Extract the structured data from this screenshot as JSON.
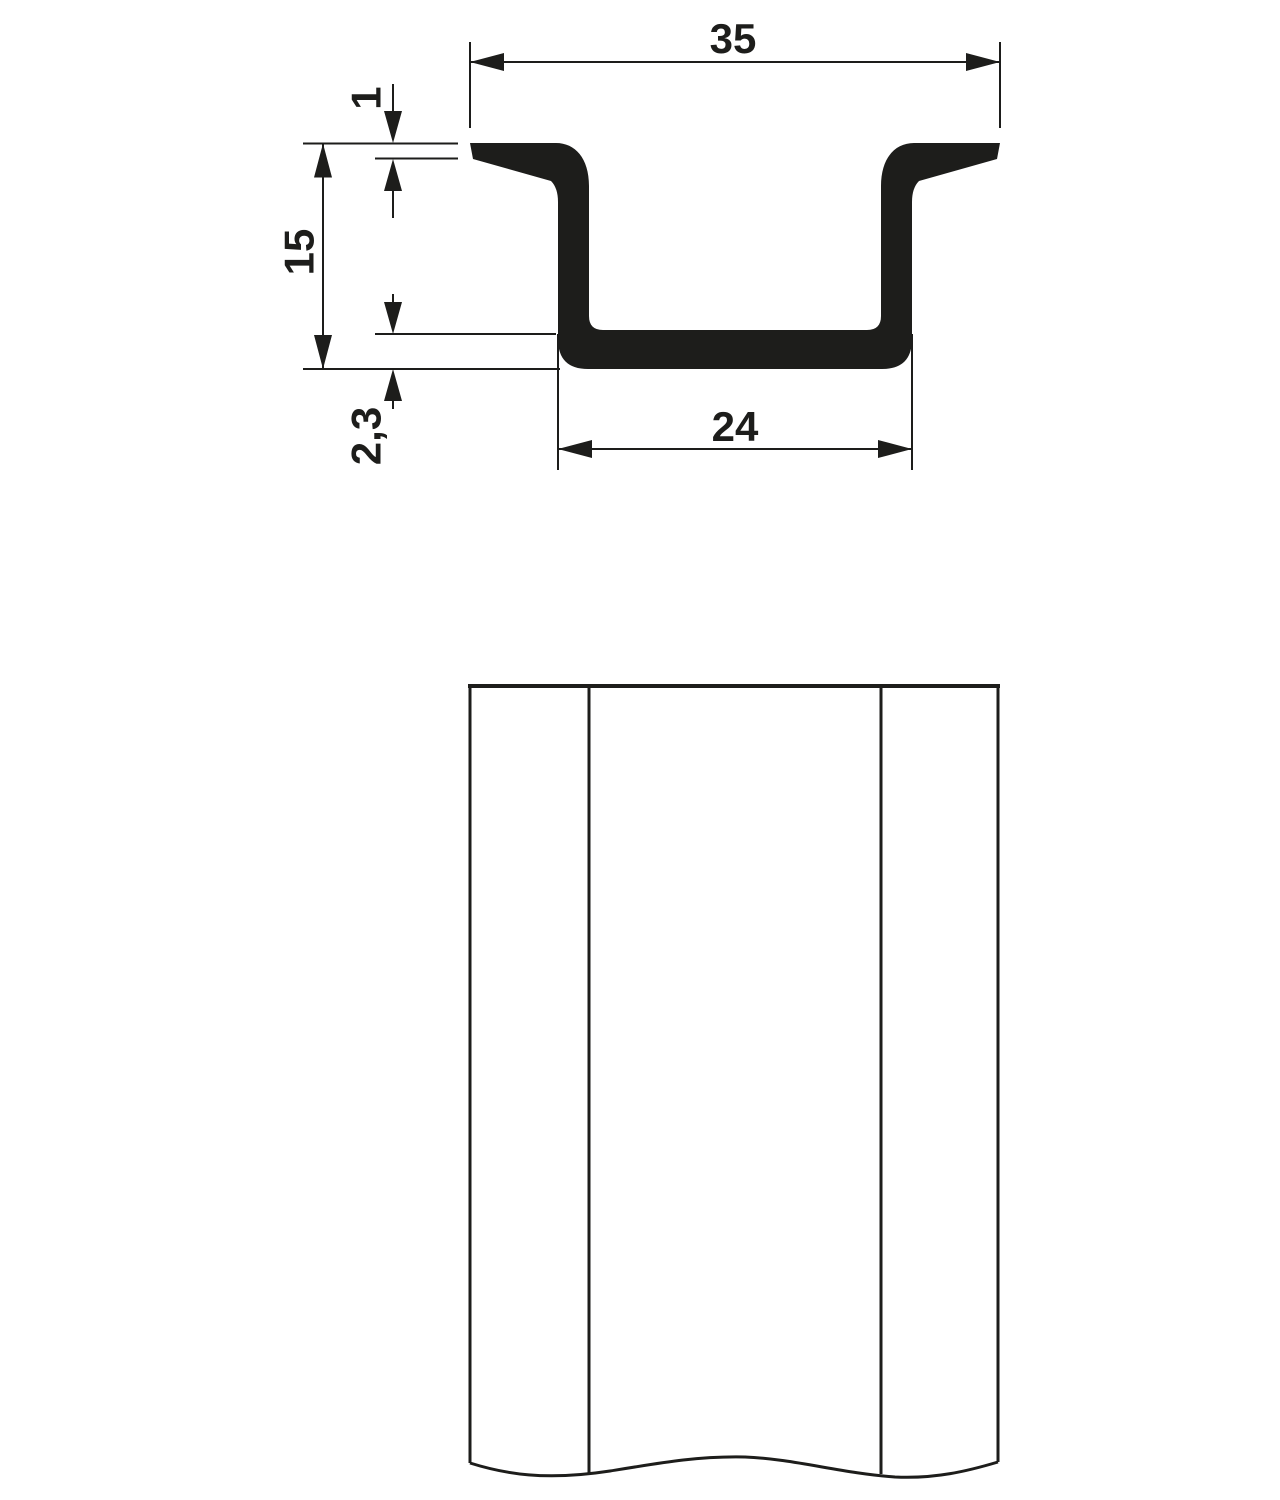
{
  "drawing": {
    "background": "#ffffff",
    "stroke_color": "#1d1d1b",
    "dims": {
      "overall_width": "35",
      "flange_thickness": "1",
      "overall_height": "15",
      "base_thickness": "2,3",
      "inner_width": "24"
    }
  }
}
